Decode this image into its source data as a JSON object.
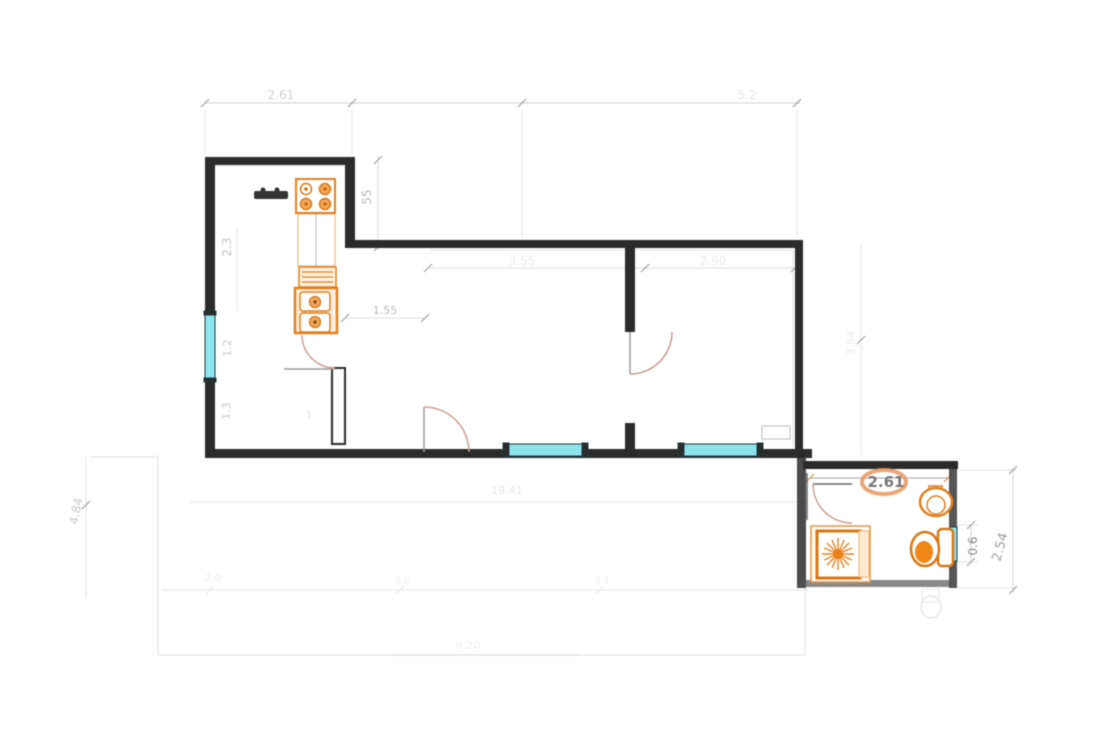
{
  "plan": {
    "type": "apartment-floor-plan",
    "colors": {
      "wall": "#2b2b2b",
      "fixture_orange": "#e2801f",
      "window_cyan": "#8ee4ef",
      "door_arc": "#c9a093",
      "dimension_gray": "#9a9a9a"
    },
    "dims": {
      "kitchen_top_width": "2.61",
      "top_right_segment": "5.2",
      "kitchen_step": "55",
      "kitchen_upper_height": "2.3",
      "kitchen_window": "1.2",
      "kitchen_lower": "1.3",
      "hall_width": "1.55",
      "hall_small": "1",
      "living_width": "3.55",
      "bedroom_width": "2.90",
      "left_height": "4.84",
      "bedroom_height": "3.84",
      "bathroom_width": "2.61",
      "bathroom_window": "0.6",
      "bathroom_height": "2.54",
      "terrace_area": "19.41",
      "terrace_seg_a": "2.0",
      "terrace_seg_b": "3.6",
      "terrace_seg_c": "3.1",
      "terrace_width": "9.20"
    },
    "fixtures": [
      "stove",
      "kitchen-counter",
      "drainer",
      "double-sink",
      "kitchen-table",
      "shower-tray",
      "wash-basin",
      "bidet",
      "toilet"
    ],
    "rooms": [
      "kitchen",
      "living-room",
      "bedroom",
      "bathroom",
      "terrace"
    ]
  }
}
